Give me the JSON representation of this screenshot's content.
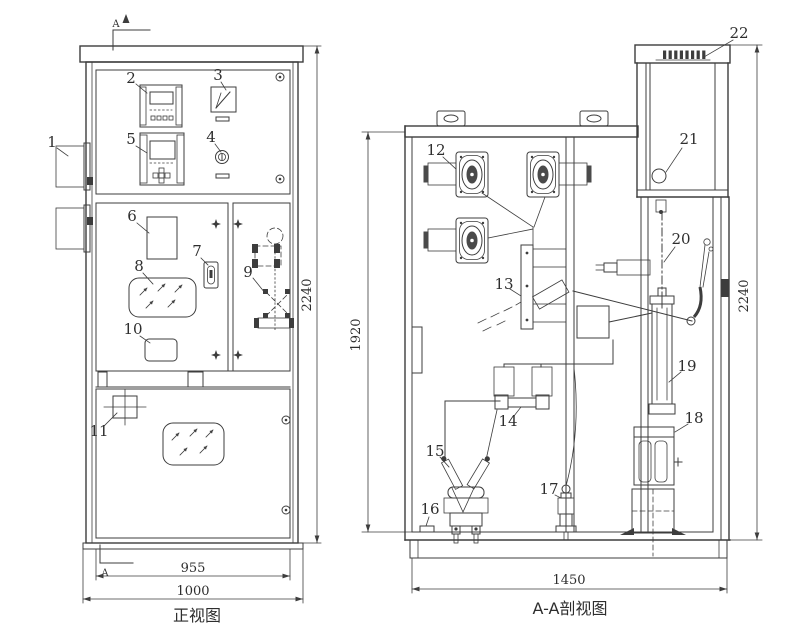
{
  "drawing": {
    "background": "#ffffff",
    "line_color": "#3d3d3d"
  },
  "front_view": {
    "caption": "正视图",
    "section_label": "A",
    "dim_height": "2240",
    "dim_width_inner": "955",
    "dim_width_outer": "1000"
  },
  "section_view": {
    "caption": "A-A剖视图",
    "dim_height_inner": "1920",
    "dim_height_outer": "2240",
    "dim_width": "1450"
  },
  "callouts": {
    "c1": "1",
    "c2": "2",
    "c3": "3",
    "c4": "4",
    "c5": "5",
    "c6": "6",
    "c7": "7",
    "c8": "8",
    "c9": "9",
    "c10": "10",
    "c11": "11",
    "c12": "12",
    "c13": "13",
    "c14": "14",
    "c15": "15",
    "c16": "16",
    "c17": "17",
    "c18": "18",
    "c19": "19",
    "c20": "20",
    "c21": "21",
    "c22": "22"
  }
}
